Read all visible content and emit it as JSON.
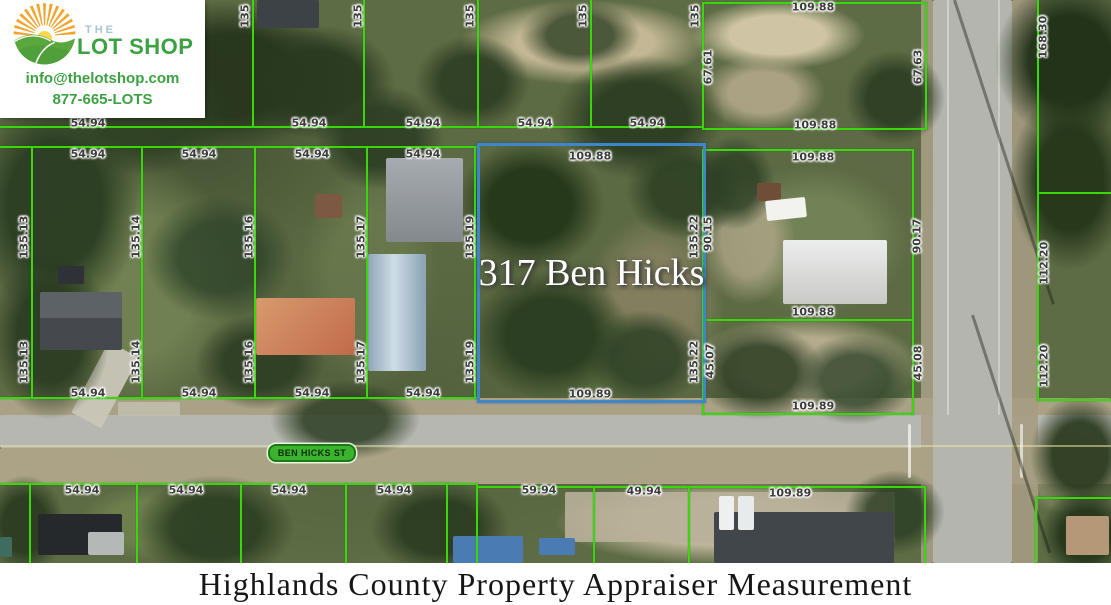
{
  "logo": {
    "brand_the": "THE",
    "brand_name": "LOT SHOP",
    "email": "info@thelotshop.com",
    "phone": "877-665-LOTS"
  },
  "caption": "Highlands County Property Appraiser Measurement",
  "colors": {
    "parcel_line_green": "#3bd60e",
    "highlight_blue": "#3e86c9",
    "brand_green": "#3ca142",
    "brand_light_blue": "#a9c6d9",
    "street_pill_green": "#3cb32f"
  },
  "map": {
    "street_label": "BEN HICKS ST",
    "highlight": {
      "label": "317 Ben Hicks",
      "x": 477,
      "y": 143,
      "w": 223,
      "h": 254
    },
    "measurements": [
      [
        "54.94",
        88,
        123,
        0
      ],
      [
        "54.94",
        309,
        123,
        0
      ],
      [
        "54.94",
        423,
        123,
        0
      ],
      [
        "54.94",
        535,
        123,
        0
      ],
      [
        "54.94",
        647,
        123,
        0
      ],
      [
        "135",
        245,
        16,
        1
      ],
      [
        "135",
        358,
        16,
        1
      ],
      [
        "135",
        470,
        16,
        1
      ],
      [
        "135",
        583,
        16,
        1
      ],
      [
        "135",
        695,
        16,
        1
      ],
      [
        "109.88",
        813,
        7,
        0
      ],
      [
        "67.61",
        708,
        67,
        1
      ],
      [
        "67.63",
        918,
        67,
        1
      ],
      [
        "109.88",
        815,
        125,
        0
      ],
      [
        "168.30",
        1043,
        37,
        1
      ],
      [
        "54.94",
        88,
        154,
        0
      ],
      [
        "54.94",
        199,
        154,
        0
      ],
      [
        "54.94",
        312,
        154,
        0
      ],
      [
        "54.94",
        423,
        154,
        0
      ],
      [
        "109.88",
        590,
        156,
        0
      ],
      [
        "109.88",
        813,
        157,
        0
      ],
      [
        "135.13",
        24,
        237,
        1
      ],
      [
        "135.14",
        136,
        237,
        1
      ],
      [
        "135.16",
        249,
        237,
        1
      ],
      [
        "135.17",
        361,
        237,
        1
      ],
      [
        "135.19",
        470,
        237,
        1
      ],
      [
        "135.22",
        694,
        237,
        1
      ],
      [
        "90.15",
        708,
        234,
        1
      ],
      [
        "90.17",
        917,
        236,
        1
      ],
      [
        "109.88",
        813,
        312,
        0
      ],
      [
        "135.13",
        24,
        362,
        1
      ],
      [
        "135.14",
        136,
        362,
        1
      ],
      [
        "135.16",
        249,
        362,
        1
      ],
      [
        "135.17",
        361,
        362,
        1
      ],
      [
        "135.19",
        470,
        362,
        1
      ],
      [
        "135.22",
        694,
        362,
        1
      ],
      [
        "45.07",
        710,
        361,
        1
      ],
      [
        "45.08",
        918,
        363,
        1
      ],
      [
        "112.20",
        1044,
        263,
        1
      ],
      [
        "112.20",
        1044,
        366,
        1
      ],
      [
        "54.94",
        88,
        393,
        0
      ],
      [
        "54.94",
        199,
        393,
        0
      ],
      [
        "54.94",
        312,
        393,
        0
      ],
      [
        "54.94",
        423,
        393,
        0
      ],
      [
        "109.89",
        590,
        394,
        0
      ],
      [
        "109.89",
        813,
        406,
        0
      ],
      [
        "54.94",
        82,
        490,
        0
      ],
      [
        "54.94",
        186,
        490,
        0
      ],
      [
        "54.94",
        289,
        490,
        0
      ],
      [
        "54.94",
        394,
        490,
        0
      ],
      [
        "59.94",
        539,
        490,
        0
      ],
      [
        "49.94",
        644,
        491,
        0
      ],
      [
        "109.89",
        790,
        493,
        0
      ]
    ],
    "parcel_lines": [
      [
        0,
        126,
        704,
        2
      ],
      [
        702,
        128,
        225,
        2
      ],
      [
        702,
        2,
        225,
        2
      ],
      [
        1037,
        192,
        74,
        2
      ],
      [
        0,
        146,
        478,
        2
      ],
      [
        702,
        149,
        212,
        2
      ],
      [
        702,
        319,
        212,
        2
      ],
      [
        0,
        397,
        478,
        2
      ],
      [
        702,
        413,
        212,
        2
      ],
      [
        1037,
        399,
        74,
        2
      ],
      [
        0,
        483,
        478,
        2
      ],
      [
        476,
        486,
        450,
        2
      ],
      [
        1035,
        497,
        76,
        2
      ],
      [
        92,
        0,
        2,
        128
      ],
      [
        252,
        0,
        2,
        128
      ],
      [
        363,
        0,
        2,
        128
      ],
      [
        477,
        0,
        2,
        128
      ],
      [
        590,
        0,
        2,
        128
      ],
      [
        702,
        2,
        2,
        128
      ],
      [
        925,
        2,
        2,
        128
      ],
      [
        1037,
        0,
        2,
        401
      ],
      [
        31,
        146,
        2,
        253
      ],
      [
        141,
        146,
        2,
        253
      ],
      [
        254,
        146,
        2,
        253
      ],
      [
        366,
        146,
        2,
        253
      ],
      [
        474,
        146,
        2,
        253
      ],
      [
        702,
        149,
        2,
        266
      ],
      [
        912,
        149,
        2,
        266
      ],
      [
        29,
        483,
        2,
        80
      ],
      [
        136,
        483,
        2,
        80
      ],
      [
        240,
        483,
        2,
        80
      ],
      [
        345,
        483,
        2,
        80
      ],
      [
        446,
        483,
        2,
        80
      ],
      [
        476,
        483,
        2,
        80
      ],
      [
        593,
        486,
        2,
        77
      ],
      [
        688,
        486,
        2,
        77
      ],
      [
        924,
        486,
        2,
        77
      ],
      [
        1035,
        497,
        2,
        66
      ]
    ]
  }
}
